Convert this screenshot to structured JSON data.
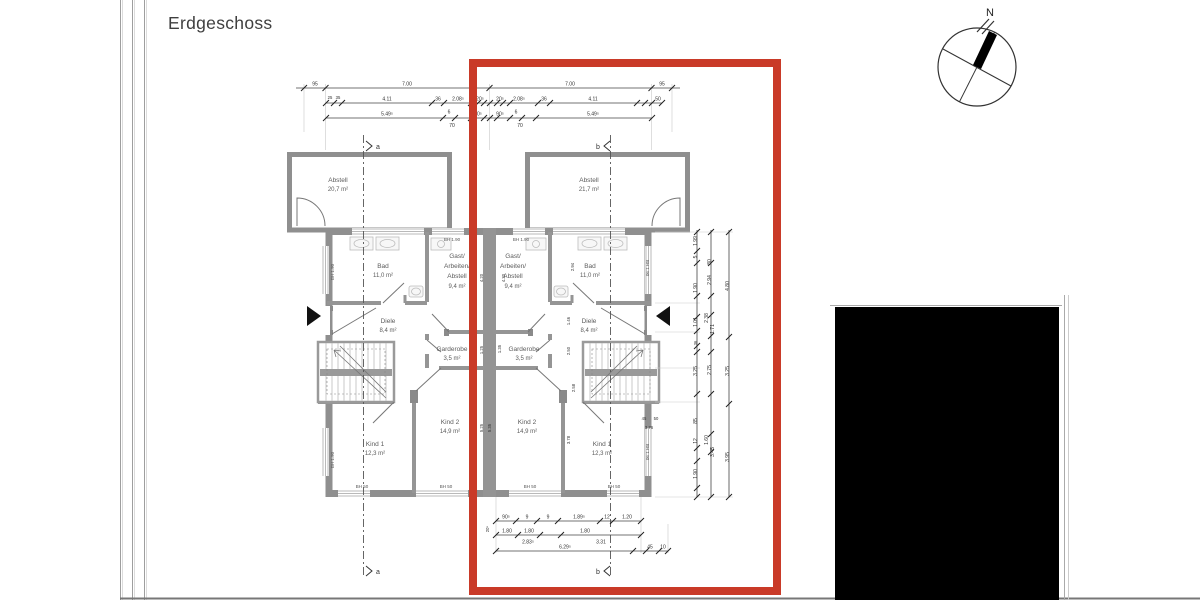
{
  "title": "Erdgeschoss",
  "compass": {
    "north": "N"
  },
  "sections": {
    "a": "a",
    "b": "b"
  },
  "rooms": {
    "abstell_left": {
      "name": "Abstell",
      "area": "20,7 m²"
    },
    "abstell_right": {
      "name": "Abstell",
      "area": "21,7 m²"
    },
    "bad_left": {
      "name": "Bad",
      "area": "11,0 m²"
    },
    "bad_right": {
      "name": "Bad",
      "area": "11,0 m²"
    },
    "gast_left": {
      "l1": "Gast/",
      "l2": "Arbeiten/",
      "l3": "Abstell",
      "area": "9,4 m²"
    },
    "gast_right": {
      "l1": "Gast/",
      "l2": "Arbeiten/",
      "l3": "Abstell",
      "area": "9,4 m²"
    },
    "diele_left": {
      "name": "Diele",
      "area": "8,4 m²"
    },
    "diele_right": {
      "name": "Diele",
      "area": "8,4 m²"
    },
    "garderobe_left": {
      "name": "Garderobe",
      "area": "3,5 m²"
    },
    "garderobe_right": {
      "name": "Garderobe",
      "area": "3,5 m²"
    },
    "kind1_left": {
      "name": "Kind 1",
      "area": "12,3 m²"
    },
    "kind2_left": {
      "name": "Kind 2",
      "area": "14,9 m²"
    },
    "kind1_right": {
      "name": "Kind 1",
      "area": "12,3 m²"
    },
    "kind2_right": {
      "name": "Kind 2",
      "area": "14,9 m²"
    }
  },
  "annotations": {
    "bh190": "BH 1.90",
    "bh50": "BH 50"
  },
  "dims": {
    "top1": [
      "95",
      "7.00",
      "7.00",
      "95"
    ],
    "top2": [
      "25",
      "35",
      "4.11",
      "36",
      "2.08⁵",
      "20⁵",
      "20⁵",
      "2.08⁵",
      "36",
      "4.11",
      "50"
    ],
    "top3": [
      "5.49⁵",
      "6",
      "70",
      "90⁵",
      "90⁵",
      "6",
      "70",
      "5.49⁵"
    ],
    "bottom1": [
      "90⁵",
      "9",
      "9",
      "1.89⁵",
      "12",
      "1.20"
    ],
    "bottom2": [
      "1.80",
      "1.80",
      "1.80",
      "2.83⁵",
      "3.31"
    ],
    "bottom3": [
      "20⁵",
      "6.29⁵",
      "45",
      "10"
    ],
    "right1": [
      "1.99",
      "5",
      "1.90",
      "1.01",
      "36",
      "3.25",
      "85",
      "12",
      "1.90"
    ],
    "right2": [
      "80",
      "2.94",
      "2.38",
      "1.71",
      "2.75",
      "1.60",
      "3.45"
    ],
    "right3": [
      "4.80",
      "3.25",
      "3.95"
    ],
    "inner_left": [
      "4.20",
      "1.25",
      "5.25"
    ],
    "inner_right": [
      "4.20",
      "2.94",
      "1.46",
      "2.50",
      "1.35",
      "2.58",
      "3.78",
      "5.35",
      "45",
      "50",
      "3.76"
    ]
  },
  "colors": {
    "highlight": "#c93a28",
    "mask": "#000000",
    "wall": "#8f8f8f"
  }
}
